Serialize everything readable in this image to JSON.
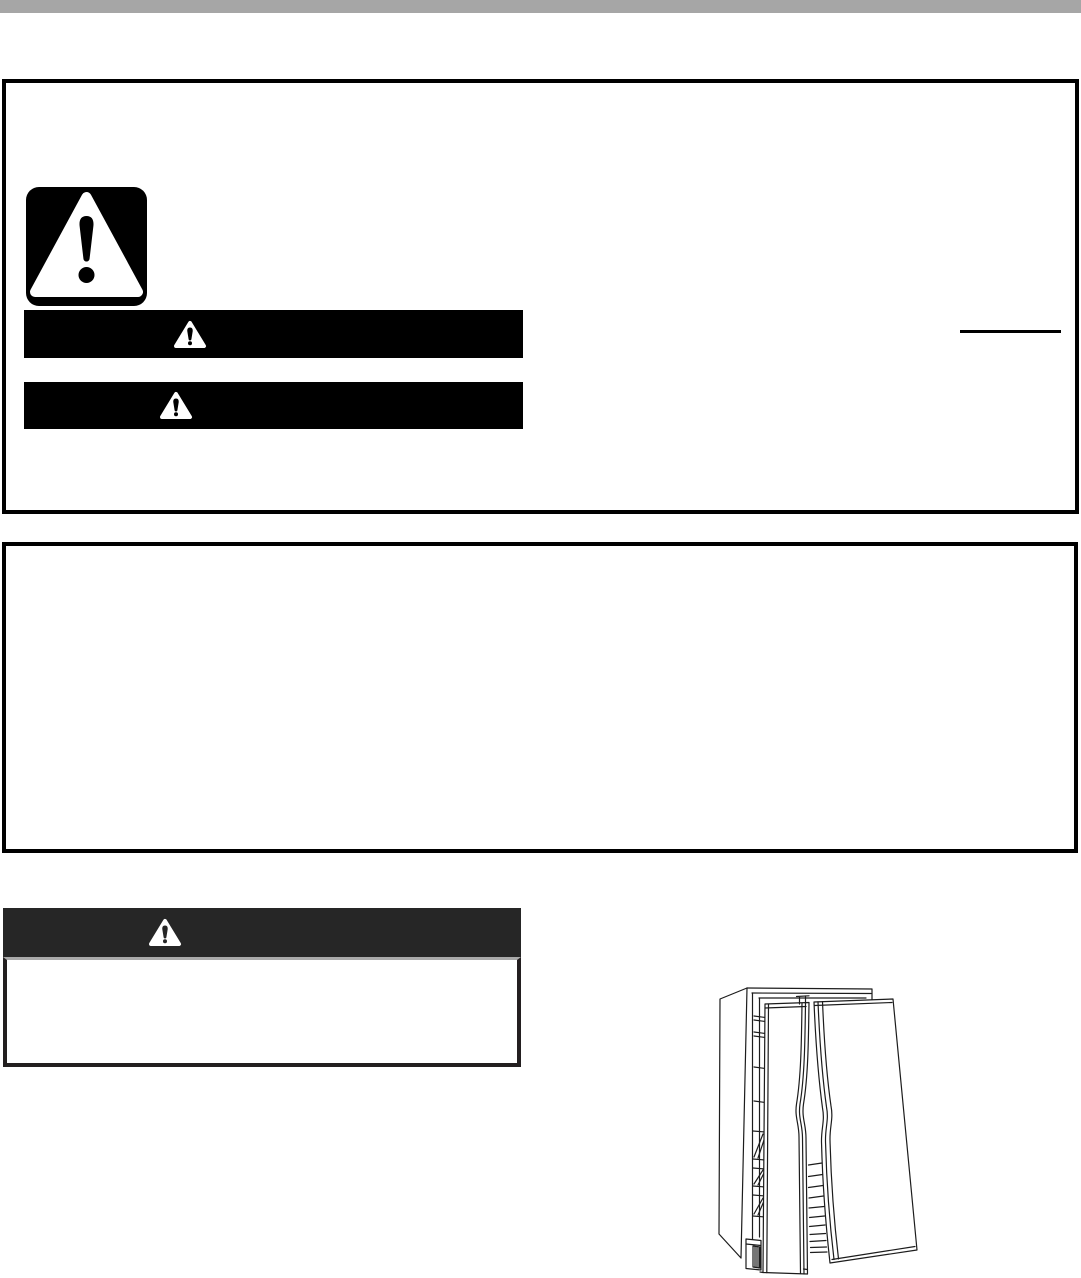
{
  "page": {
    "width": 1081,
    "height": 1278,
    "background": "#ffffff"
  },
  "colors": {
    "top_bar": "#a6a6a6",
    "box_border": "#000000",
    "banner_black": "#000000",
    "banner_charcoal": "#262626",
    "warning_box_border": "#231f20",
    "warning_box_top_border": "#a9a9a9",
    "note_rule": "#000000",
    "triangle_fill": "#ffffff",
    "line_art": "#1c1c1c"
  },
  "icons": {
    "safety_alert": "safety-alert-icon",
    "warning_triangle": "warning-triangle-icon"
  },
  "sections": {
    "top_safety_box": {
      "banners": [
        {
          "label": ""
        },
        {
          "label": ""
        }
      ],
      "note_rule_present": true
    },
    "secondary_box": {
      "content": ""
    },
    "charcoal_warning": {
      "label": "",
      "body": ""
    }
  },
  "figure": {
    "alt": "side-by-side-refrigerator-doors-open-line-drawing"
  }
}
